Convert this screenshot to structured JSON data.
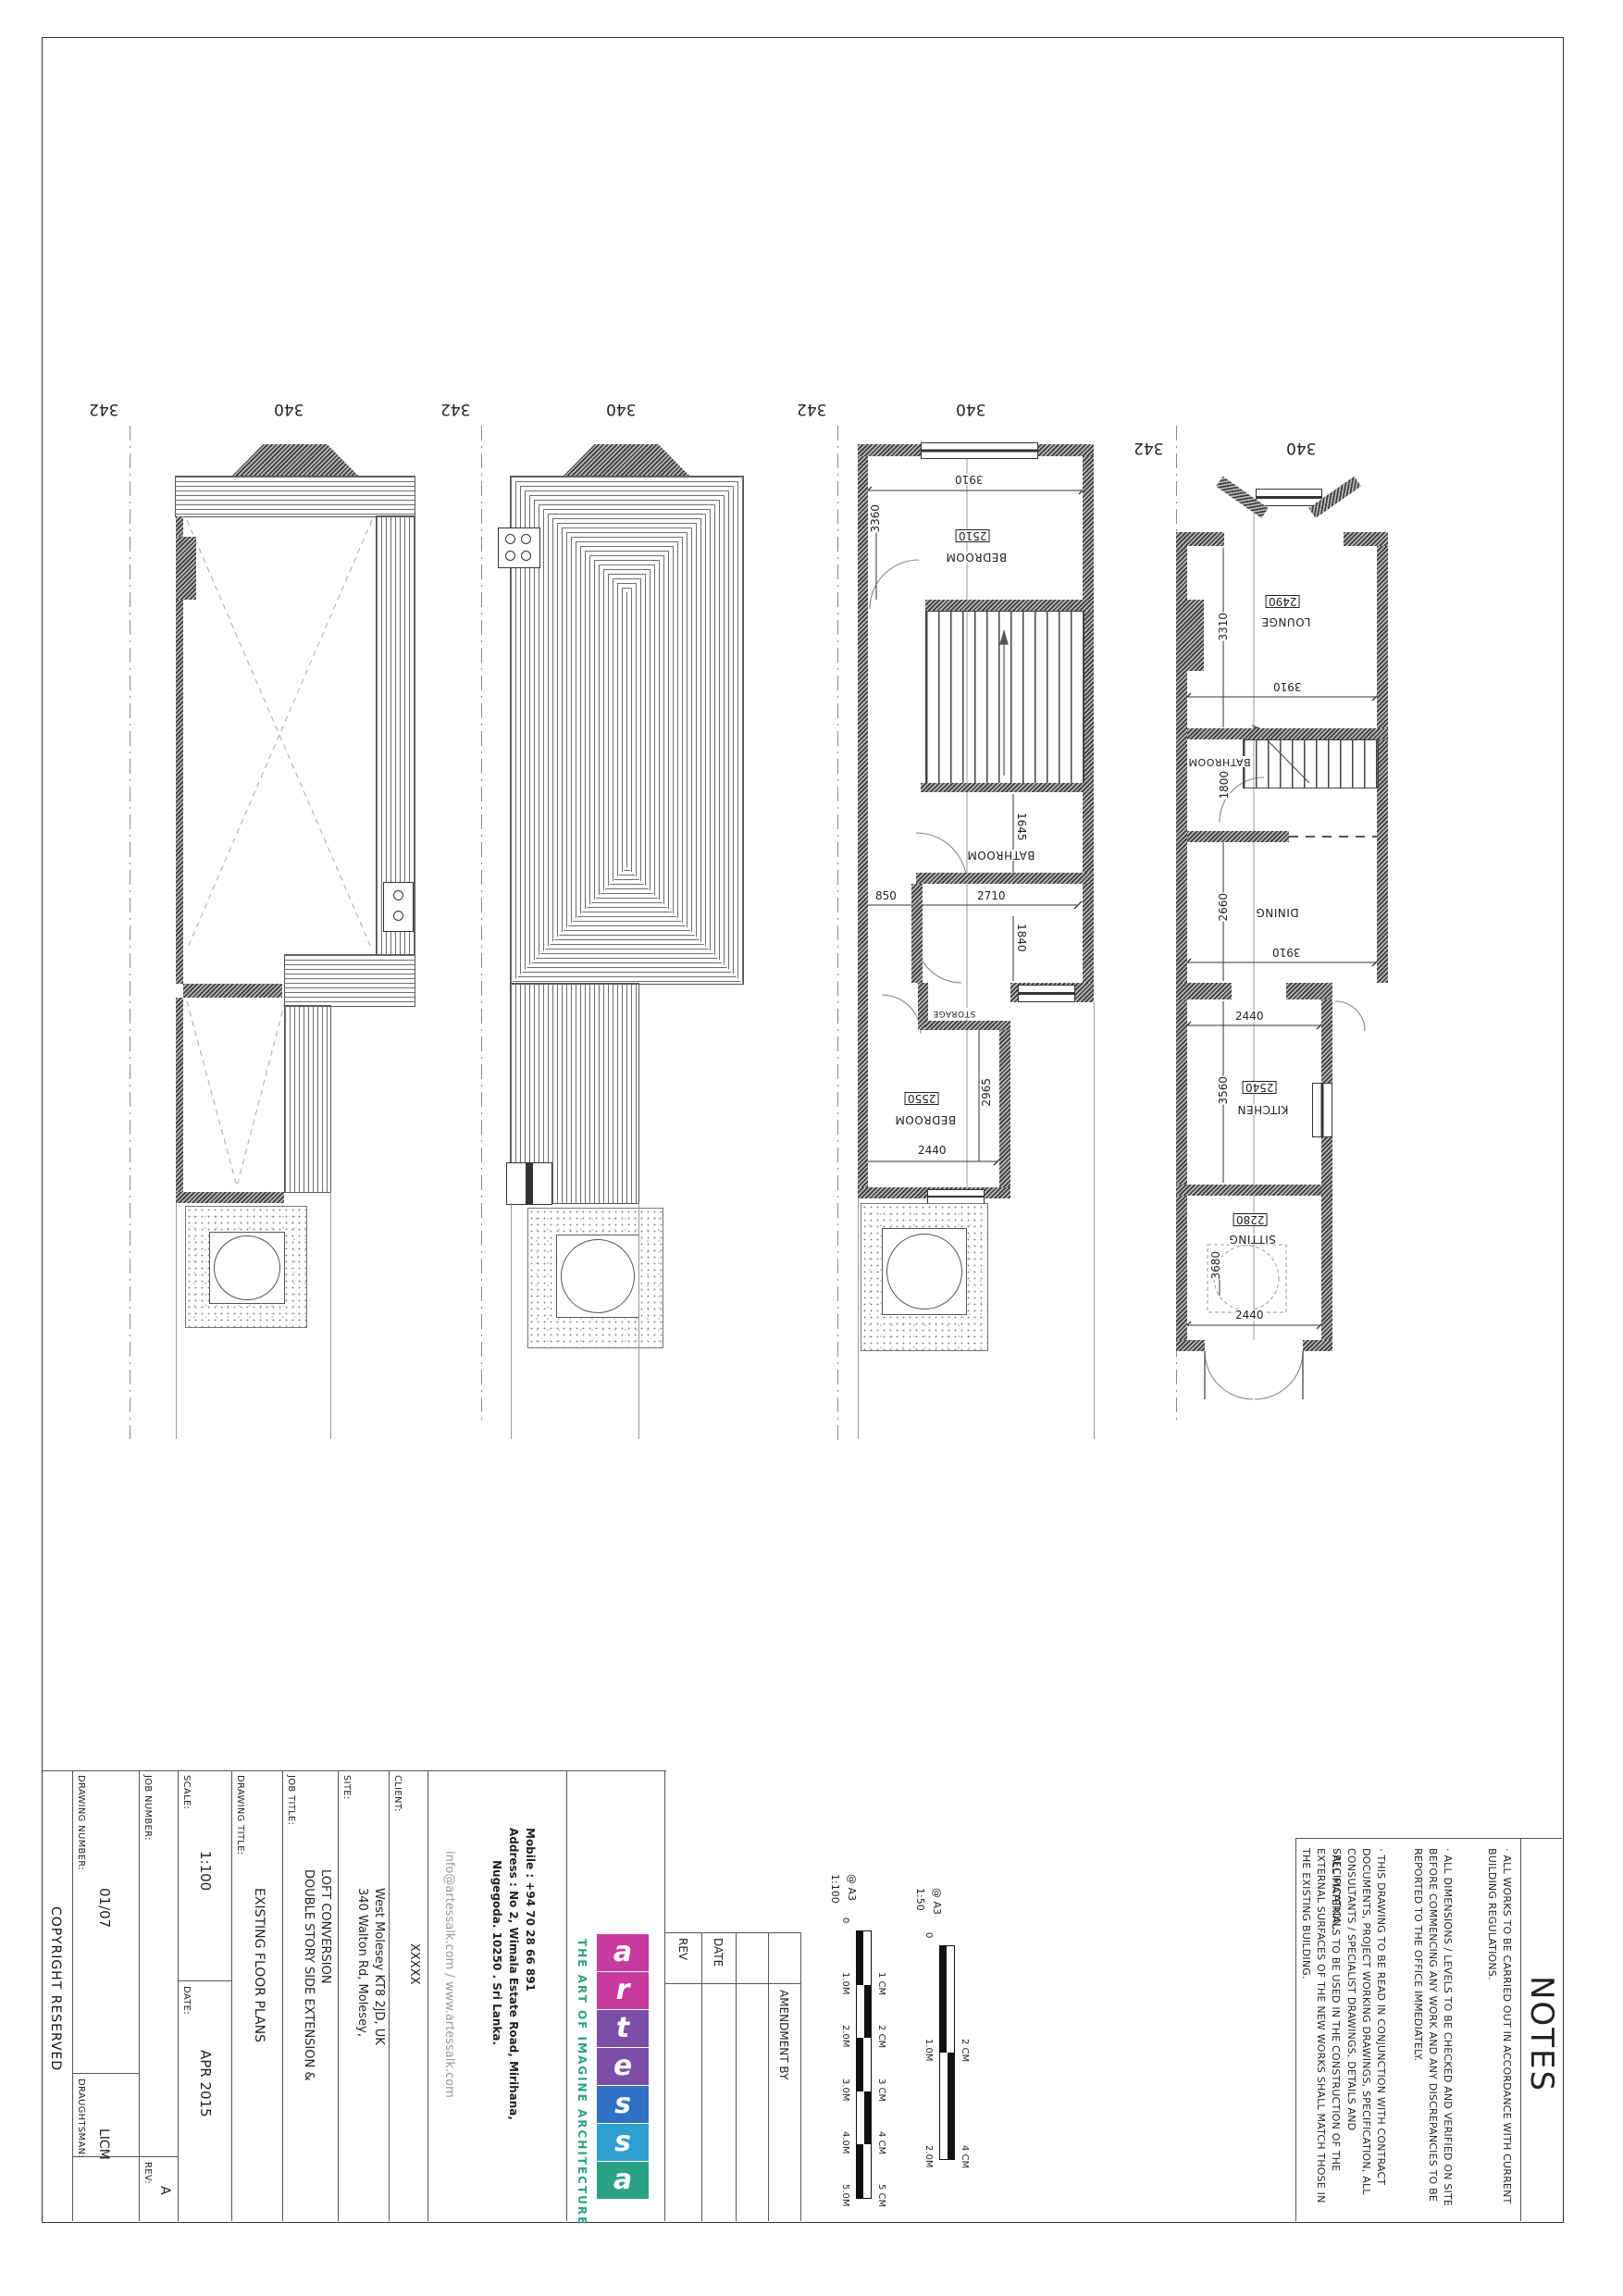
{
  "grid": {
    "left": "342",
    "right": "340"
  },
  "first_floor": {
    "w3910": "3910",
    "h2510": "2510",
    "bedroom": "BEDROOM",
    "d3360": "3360",
    "bathroom": "BATHROOM",
    "d1645": "1645",
    "w850": "850",
    "w2710": "2710",
    "d1840": "1840",
    "storage": "STORAGE",
    "h2550": "2550",
    "bedroom2": "BEDROOM",
    "d2965": "2965",
    "w2440": "2440"
  },
  "ground_floor": {
    "h2490": "2490",
    "lounge": "LOUNGE",
    "d3310": "3310",
    "w3910": "3910",
    "bathroom": "BATHROOM",
    "d1800": "1800",
    "d2660": "2660",
    "dining": "DINING",
    "w3910b": "3910",
    "w2440a": "2440",
    "d3560": "3560",
    "h2540": "2540",
    "kitchen": "KITCHEN",
    "h2280": "2280",
    "sitting": "SITTING",
    "d3680": "3680",
    "w2440b": "2440"
  },
  "title_block": {
    "copyright": "COPYRIGHT RESERVED",
    "drawing_number_label": "DRAWING NUMBER:",
    "drawing_number": "01/07",
    "draughtsman_label": "DRAUGHTSMAN:",
    "draughtsman": "LICM",
    "rev_label": "REV:",
    "rev": "A",
    "job_number_label": "JOB NUMBER:",
    "scale_label": "SCALE:",
    "scale": "1:100",
    "date_label": "DATE:",
    "date": "APR 2015",
    "drawing_title_label": "DRAWING TITLE:",
    "drawing_title": "EXISTING FLOOR PLANS",
    "job_title_label": "JOB TITLE:",
    "job_title_line1": "DOUBLE STORY SIDE EXTENSION &",
    "job_title_line2": "LOFT CONVERSION",
    "site_label": "SITE:",
    "site_line1": "340 Walton Rd, Molesey,",
    "site_line2": "West Molesey KT8 2JD, UK",
    "client_label": "CLIENT:",
    "client": "XXXXX",
    "email_web": "info@artessalk.com / www.artessalk.com",
    "mobile": "Mobile : +94 70 28 66 891",
    "address_line1": "Address : No 2, Wimala Estate Road, Mirihana,",
    "address_line2": "Nugegoda.  10250 . Sri Lanka."
  },
  "logo": {
    "tagline": "THE ART OF IMAGINE ARCHITECTURE",
    "letters": [
      "a",
      "r",
      "t",
      "e",
      "s",
      "s",
      "a"
    ],
    "tile_colors": [
      "#c73b9e",
      "#c73b9e",
      "#7b4fa8",
      "#7b4fa8",
      "#2f72c3",
      "#2f9fd0",
      "#2ba183"
    ],
    "tagline_color": "#2ba183"
  },
  "amendments": {
    "rev": "REV",
    "date": "DATE",
    "amendment_by": "AMENDMENT BY"
  },
  "scale_bars": {
    "bar100": {
      "scale": "1:100",
      "sheet": "@ A3",
      "left_ticks": [
        "0",
        "1.0M",
        "2.0M",
        "3.0M",
        "4.0M",
        "5.0M"
      ],
      "right_ticks": [
        "1 CM",
        "2 CM",
        "3 CM",
        "4 CM",
        "5 CM"
      ]
    },
    "bar50": {
      "scale": "1:50",
      "sheet": "@ A3",
      "left_ticks": [
        "0",
        "1.0M",
        "2.0M"
      ],
      "right_ticks": [
        "2 CM",
        "4 CM"
      ]
    }
  },
  "notes": {
    "heading": "NOTES",
    "paragraphs": [
      {
        "text": "·  ALL WORKS TO BE CARRIED OUT IN ACCORDANCE WITH CURRENT BUILDING REGULATIONS."
      },
      {
        "text": "·  ALL DIMENSIONS / LEVELS TO BE CHECKED AND VERIFIED ON SITE BEFORE COMMENCING ANY WORK AND ANY DISCREPANCIES TO BE REPORTED TO THE OFFICE IMMEDIATELY."
      },
      {
        "text": "·  THIS DRAWING TO BE READ IN CONJUNCTION WITH CONTRACT DOCUMENTS, PROJECT WORKING DRAWINGS, SPECIFICATION, ALL CONSULTANTS / SPECIALIST DRAWINGS, DETAILS AND SPECIFICATION."
      },
      {
        "text": "·  ALL MATERIALS TO BE USED IN THE CONSTRUCTION OF THE EXTERNAL SURFACES OF THE NEW WORKS SHALL MATCH THOSE IN THE EXISTING BUILDING."
      }
    ]
  }
}
